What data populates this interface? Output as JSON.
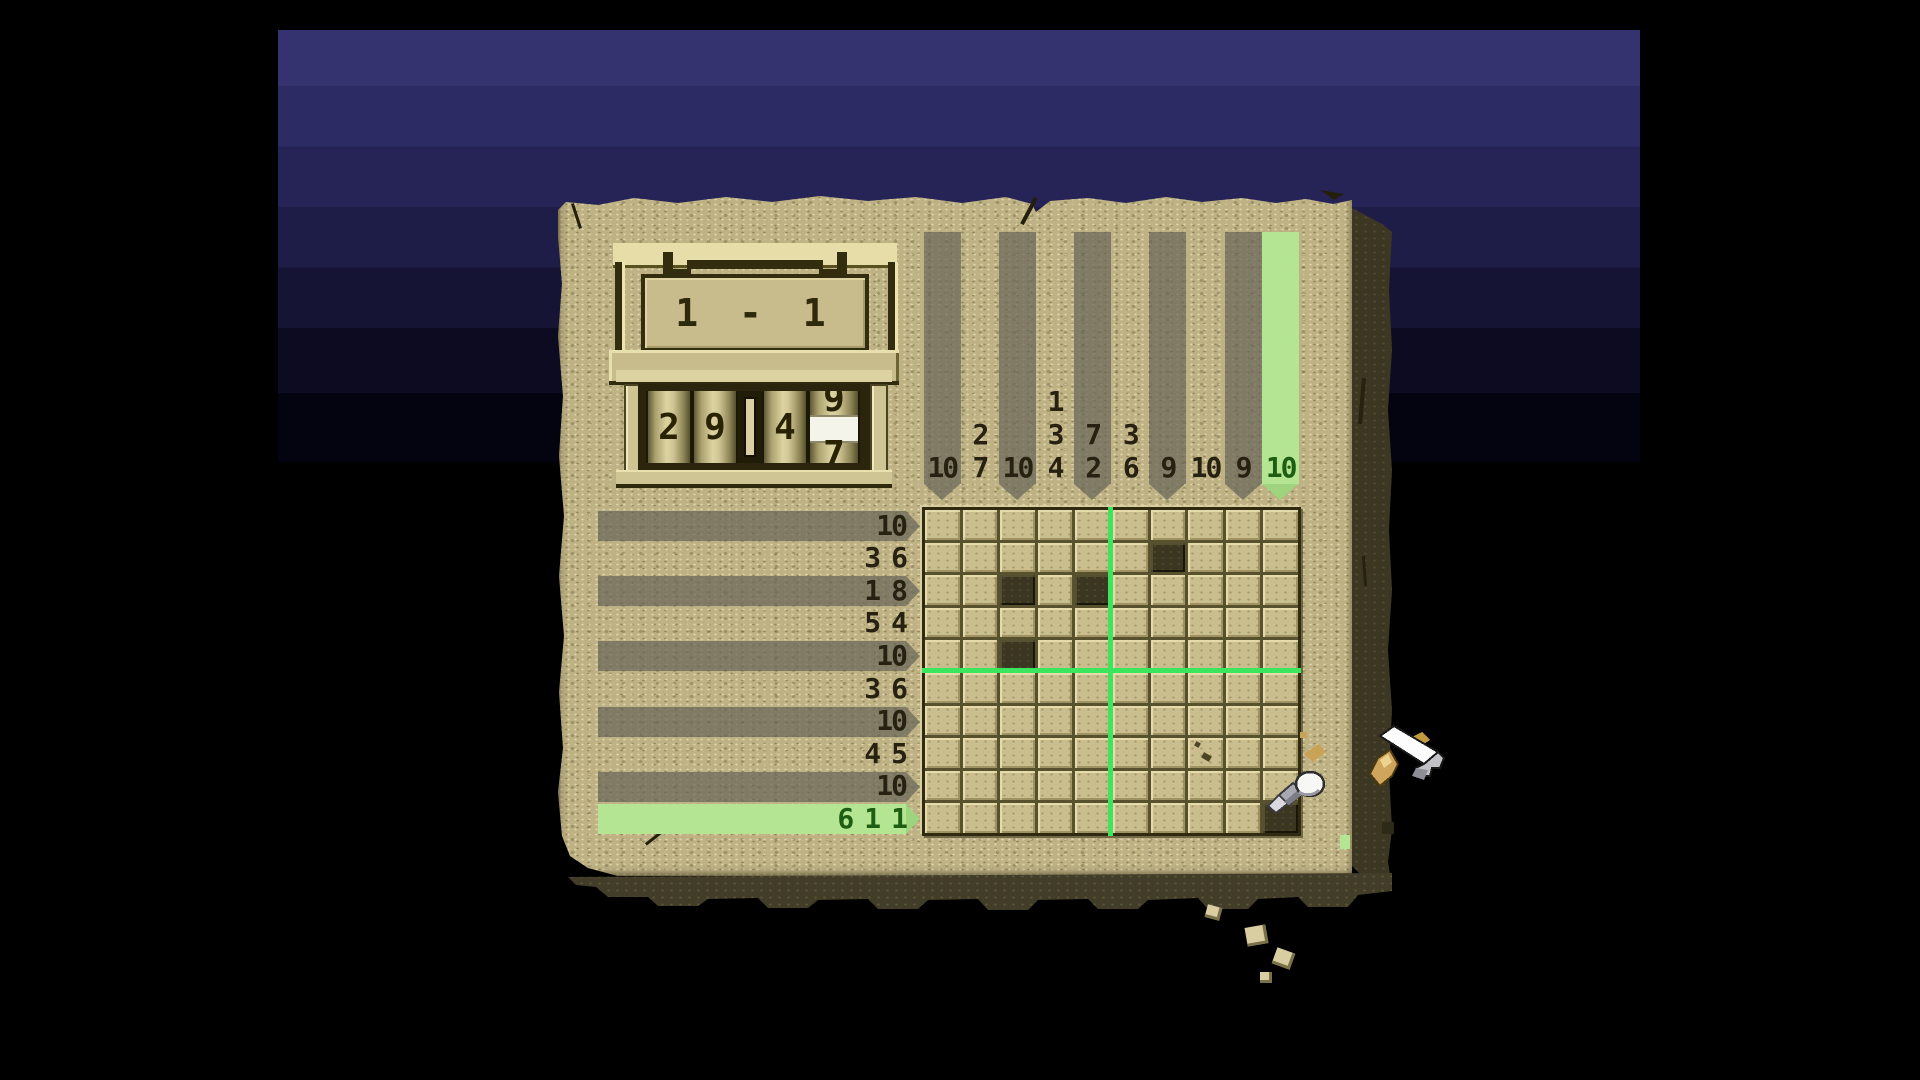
{
  "app": {
    "name": "picross-puzzle-screen"
  },
  "level_plaque": {
    "label": "1 - 1"
  },
  "timer": {
    "minutes": "29",
    "seconds_tens": "4",
    "rolling_digit_top": "9",
    "rolling_digit_bottom": "7"
  },
  "puzzle": {
    "grid_rows": 10,
    "grid_cols": 10,
    "row_hints": [
      [
        "10"
      ],
      [
        "3",
        "6"
      ],
      [
        "1",
        "8"
      ],
      [
        "5",
        "4"
      ],
      [
        "10"
      ],
      [
        "3",
        "6"
      ],
      [
        "10"
      ],
      [
        "4",
        "5"
      ],
      [
        "10"
      ],
      [
        "6",
        "1",
        "1"
      ]
    ],
    "col_hints": [
      [
        "10"
      ],
      [
        "2",
        "7"
      ],
      [
        "10"
      ],
      [
        "1",
        "3",
        "4"
      ],
      [
        "7",
        "2"
      ],
      [
        "3",
        "6"
      ],
      [
        "9"
      ],
      [
        "10"
      ],
      [
        "9"
      ],
      [
        "10"
      ]
    ],
    "filled_cells": [
      {
        "row": 2,
        "col": 7
      },
      {
        "row": 3,
        "col": 3
      },
      {
        "row": 3,
        "col": 5
      },
      {
        "row": 5,
        "col": 3
      },
      {
        "row": 10,
        "col": 10
      }
    ],
    "highlighted_row": 10,
    "highlighted_col": 10,
    "block_divider_after_col": 5,
    "block_divider_after_row": 5
  },
  "cursor": {
    "type": "chisel-with-hammer",
    "row": 10,
    "col": 10
  },
  "colors": {
    "background": "#000000",
    "sky_top": "#34326f",
    "sky_bottom": "#040410",
    "stone": "#c2b587",
    "stone_side": "#3c3722",
    "grid_line": "#57512e",
    "cell": "#cbbe8e",
    "cell_filled": "#3b3621",
    "stripe_gray": "#8e8a77",
    "stripe_green": "#b3e592",
    "hint_text": "#262110",
    "hint_text_green": "#1e5e12",
    "crosshair_green": "#3ce65c"
  }
}
